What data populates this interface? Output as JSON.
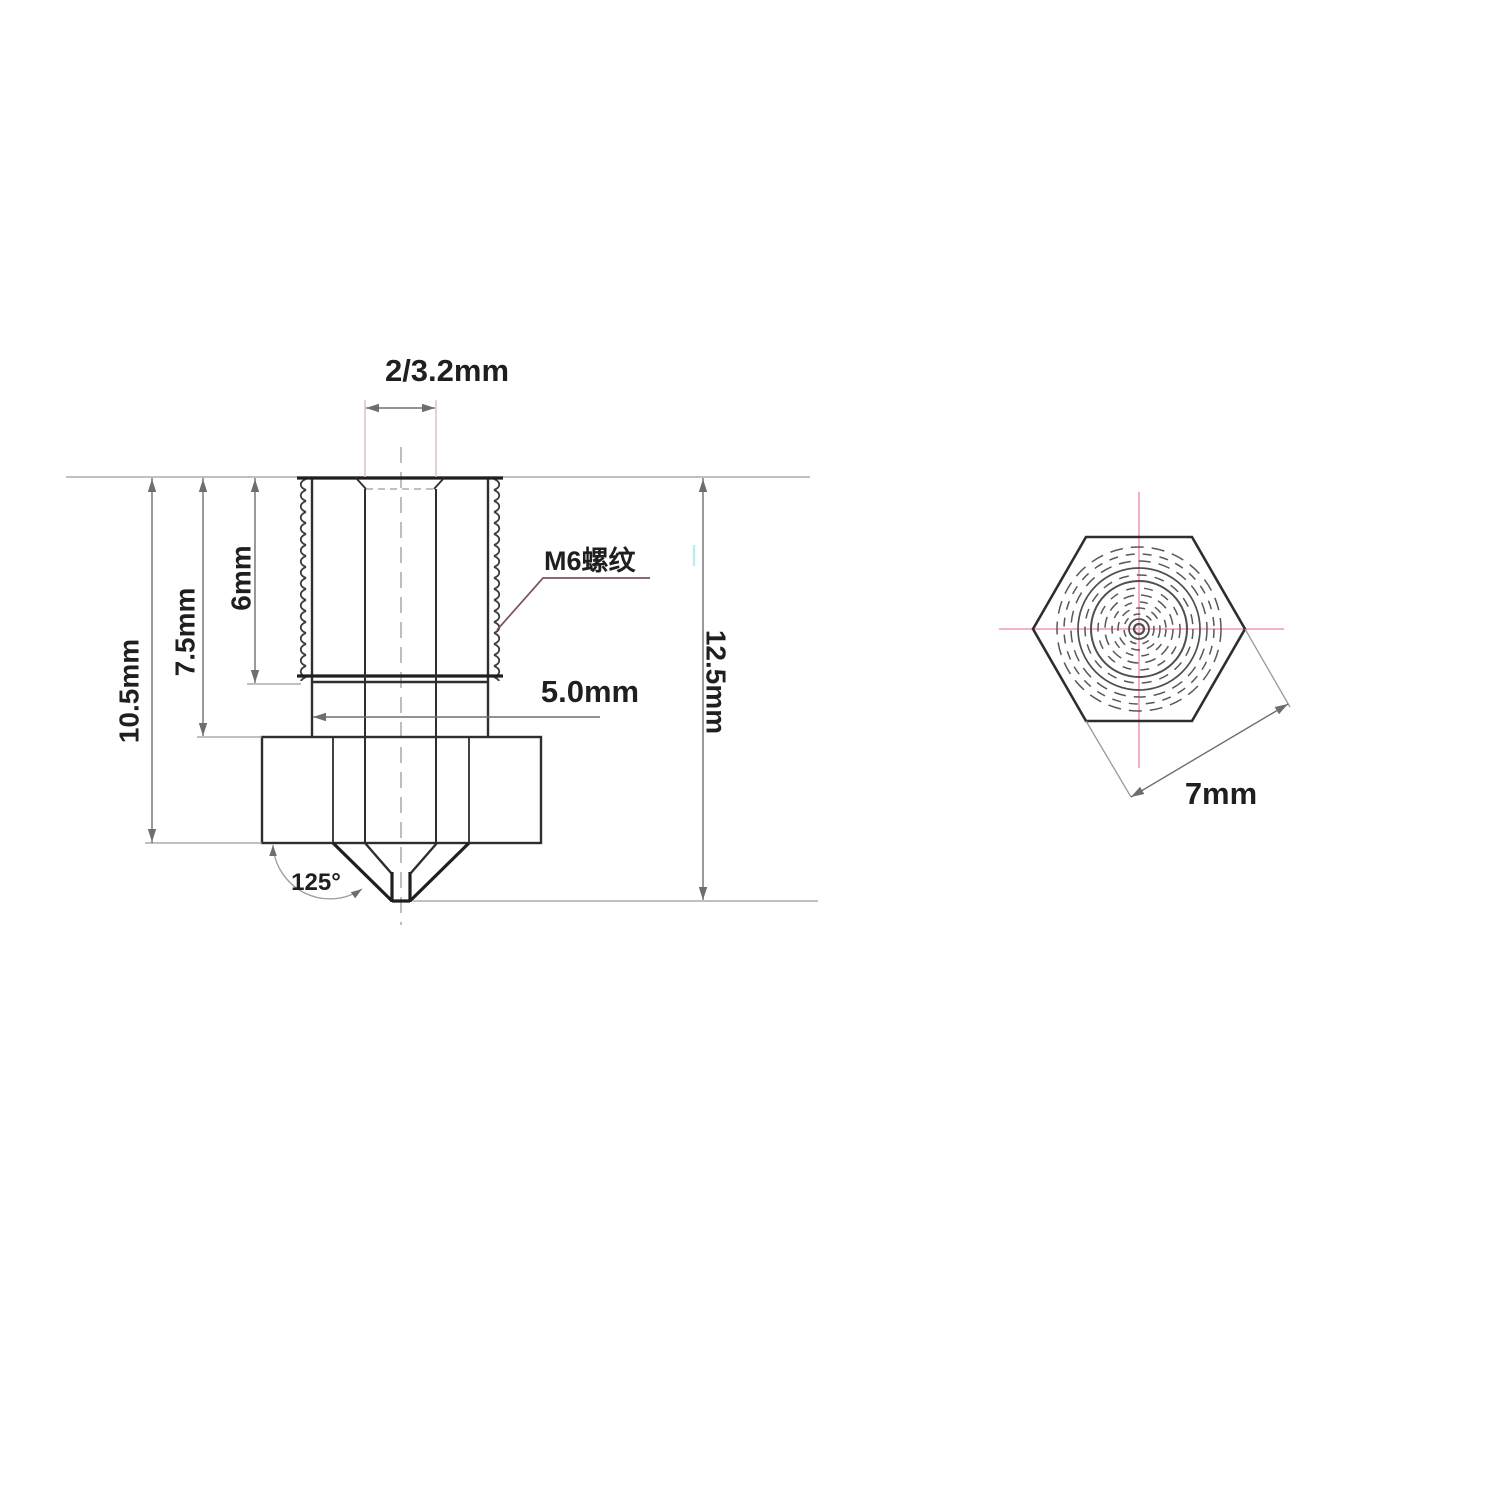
{
  "drawing": {
    "type": "technical-dimension-drawing",
    "subject": "3D printer extruder nozzle",
    "views": {
      "side_view": {
        "labels": {
          "bore_diameter": "2/3.2mm",
          "thread_spec": "M6螺纹",
          "neck_diameter": "5.0mm",
          "thread_length": "6mm",
          "upper_length": "7.5mm",
          "body_length": "10.5mm",
          "overall_length": "12.5mm",
          "tip_angle": "125°"
        }
      },
      "end_view": {
        "labels": {
          "hex_across_flats": "7mm"
        }
      }
    }
  },
  "colors": {
    "outline": "#2e2e2e",
    "heavy": "#1f1f1f",
    "dim_line": "#6e6e6e",
    "ext_line": "#9a9a9a",
    "pink": "#f09cb2",
    "light_pink": "#d9c0d2",
    "leader": "#7a5460",
    "text": "#1f1f1f",
    "artifact_cyan": "#b9ecf3"
  }
}
